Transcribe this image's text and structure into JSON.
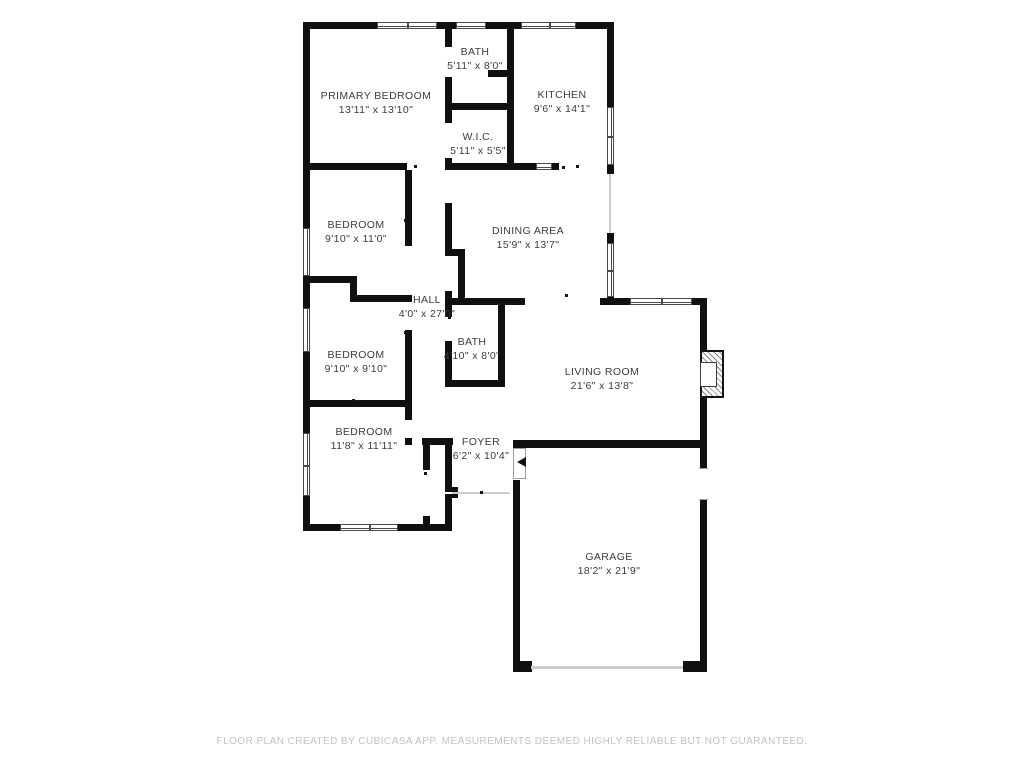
{
  "footer": {
    "disclaimer": "FLOOR PLAN CREATED BY CUBICASA APP. MEASUREMENTS DEEMED HIGHLY RELIABLE BUT NOT GUARANTEED."
  },
  "floorplan": {
    "colors": {
      "wall": "#101010",
      "label": "#3b3b3b",
      "footer": "#c2c2c2",
      "window_frame": "#4a4a4a"
    },
    "rooms": [
      {
        "name": "PRIMARY BEDROOM",
        "dimensions": "13'11\" x 13'10\"",
        "cx": 376,
        "cy": 103
      },
      {
        "name": "BATH",
        "dimensions": "5'11\" x 8'0\"",
        "cx": 475,
        "cy": 59
      },
      {
        "name": "KITCHEN",
        "dimensions": "9'6\" x 14'1\"",
        "cx": 562,
        "cy": 102
      },
      {
        "name": "W.I.C.",
        "dimensions": "5'11\" x 5'5\"",
        "cx": 478,
        "cy": 144
      },
      {
        "name": "BEDROOM",
        "dimensions": "9'10\" x 11'0\"",
        "cx": 356,
        "cy": 232
      },
      {
        "name": "DINING AREA",
        "dimensions": "15'9\" x 13'7\"",
        "cx": 528,
        "cy": 238
      },
      {
        "name": "HALL",
        "dimensions": "4'0\" x 27'0\"",
        "cx": 427,
        "cy": 307
      },
      {
        "name": "BATH",
        "dimensions": "4'10\" x 8'0\"",
        "cx": 472,
        "cy": 349
      },
      {
        "name": "BEDROOM",
        "dimensions": "9'10\" x 9'10\"",
        "cx": 356,
        "cy": 362
      },
      {
        "name": "LIVING ROOM",
        "dimensions": "21'6\" x 13'8\"",
        "cx": 602,
        "cy": 379
      },
      {
        "name": "BEDROOM",
        "dimensions": "11'8\" x 11'11\"",
        "cx": 364,
        "cy": 439
      },
      {
        "name": "FOYER",
        "dimensions": "6'2\" x 10'4\"",
        "cx": 481,
        "cy": 449
      },
      {
        "name": "GARAGE",
        "dimensions": "18'2\" x 21'9\"",
        "cx": 609,
        "cy": 564
      }
    ],
    "walls": [
      [
        305,
        22,
        72,
        7
      ],
      [
        437,
        22,
        19,
        7
      ],
      [
        486,
        22,
        35,
        7
      ],
      [
        576,
        22,
        38,
        7
      ],
      [
        303,
        22,
        7,
        206
      ],
      [
        303,
        276,
        7,
        32
      ],
      [
        303,
        352,
        7,
        81
      ],
      [
        303,
        496,
        7,
        35
      ],
      [
        607,
        29,
        7,
        78
      ],
      [
        607,
        165,
        7,
        9
      ],
      [
        607,
        233,
        7,
        10
      ],
      [
        607,
        297,
        7,
        8
      ],
      [
        445,
        29,
        7,
        18
      ],
      [
        445,
        77,
        7,
        46
      ],
      [
        445,
        158,
        7,
        12
      ],
      [
        445,
        103,
        62,
        7
      ],
      [
        488,
        70,
        24,
        7
      ],
      [
        507,
        29,
        7,
        141
      ],
      [
        305,
        163,
        102,
        7
      ],
      [
        445,
        163,
        69,
        7
      ],
      [
        514,
        163,
        22,
        7
      ],
      [
        552,
        163,
        7,
        7
      ],
      [
        405,
        170,
        7,
        76
      ],
      [
        305,
        276,
        52,
        7
      ],
      [
        350,
        283,
        7,
        14
      ],
      [
        350,
        295,
        62,
        7
      ],
      [
        445,
        203,
        7,
        49
      ],
      [
        445,
        249,
        20,
        7
      ],
      [
        458,
        256,
        7,
        44
      ],
      [
        445,
        291,
        7,
        14
      ],
      [
        445,
        298,
        80,
        7
      ],
      [
        498,
        305,
        7,
        82
      ],
      [
        445,
        305,
        7,
        12
      ],
      [
        445,
        341,
        7,
        46
      ],
      [
        445,
        380,
        60,
        7
      ],
      [
        600,
        298,
        30,
        7
      ],
      [
        692,
        298,
        15,
        7
      ],
      [
        700,
        305,
        7,
        45
      ],
      [
        700,
        398,
        7,
        45
      ],
      [
        513,
        440,
        194,
        8
      ],
      [
        405,
        330,
        7,
        77
      ],
      [
        305,
        400,
        107,
        7
      ],
      [
        405,
        407,
        7,
        13
      ],
      [
        405,
        438,
        7,
        7
      ],
      [
        422,
        438,
        31,
        7
      ],
      [
        423,
        445,
        7,
        25
      ],
      [
        423,
        516,
        7,
        10
      ],
      [
        445,
        438,
        7,
        54
      ],
      [
        452,
        487,
        6,
        11
      ],
      [
        445,
        494,
        7,
        37
      ],
      [
        305,
        524,
        35,
        7
      ],
      [
        398,
        524,
        54,
        7
      ],
      [
        513,
        480,
        7,
        188
      ],
      [
        513,
        661,
        19,
        11
      ],
      [
        683,
        661,
        24,
        11
      ],
      [
        700,
        440,
        7,
        28
      ],
      [
        700,
        500,
        7,
        172
      ]
    ],
    "windows": [
      {
        "rect": [
          377,
          22,
          60,
          7
        ],
        "dir": "h",
        "mullion": true
      },
      {
        "rect": [
          456,
          22,
          30,
          7
        ],
        "dir": "h",
        "mullion": false
      },
      {
        "rect": [
          521,
          22,
          55,
          7
        ],
        "dir": "h",
        "mullion": true
      },
      {
        "rect": [
          303,
          228,
          7,
          48
        ],
        "dir": "v",
        "mullion": false
      },
      {
        "rect": [
          303,
          308,
          7,
          44
        ],
        "dir": "v",
        "mullion": false
      },
      {
        "rect": [
          303,
          433,
          7,
          63
        ],
        "dir": "v",
        "mullion": true
      },
      {
        "rect": [
          607,
          107,
          7,
          58
        ],
        "dir": "v",
        "mullion": true
      },
      {
        "rect": [
          607,
          243,
          7,
          54
        ],
        "dir": "v",
        "mullion": true
      },
      {
        "rect": [
          630,
          298,
          62,
          7
        ],
        "dir": "h",
        "mullion": true
      },
      {
        "rect": [
          340,
          524,
          58,
          7
        ],
        "dir": "h",
        "mullion": true
      },
      {
        "rect": [
          536,
          163,
          16,
          7
        ],
        "dir": "h",
        "mullion": false
      }
    ],
    "openings": [
      [
        609,
        174,
        2,
        59
      ],
      [
        452,
        492,
        58,
        2
      ],
      [
        531,
        666,
        152,
        3
      ]
    ],
    "dots": [
      [
        414,
        165
      ],
      [
        562,
        166
      ],
      [
        576,
        165
      ],
      [
        404,
        219
      ],
      [
        404,
        331
      ],
      [
        448,
        316
      ],
      [
        480,
        491
      ],
      [
        424,
        472
      ],
      [
        565,
        294
      ],
      [
        352,
        399
      ]
    ],
    "fixtures": [
      {
        "type": "door-leaf",
        "name": "garage-entry-door",
        "rect": [
          513,
          448,
          13,
          31
        ]
      },
      {
        "type": "door-gap",
        "name": "garage-side-door",
        "rect": [
          699,
          468,
          9,
          32
        ]
      },
      {
        "type": "door-arrow",
        "name": "door-swing-arrow",
        "rect": [
          517,
          457,
          9,
          10
        ]
      },
      {
        "type": "fireplace",
        "name": "fireplace",
        "rect": [
          700,
          350,
          24,
          48
        ],
        "inner": [
          700,
          362,
          17,
          25
        ]
      }
    ]
  }
}
